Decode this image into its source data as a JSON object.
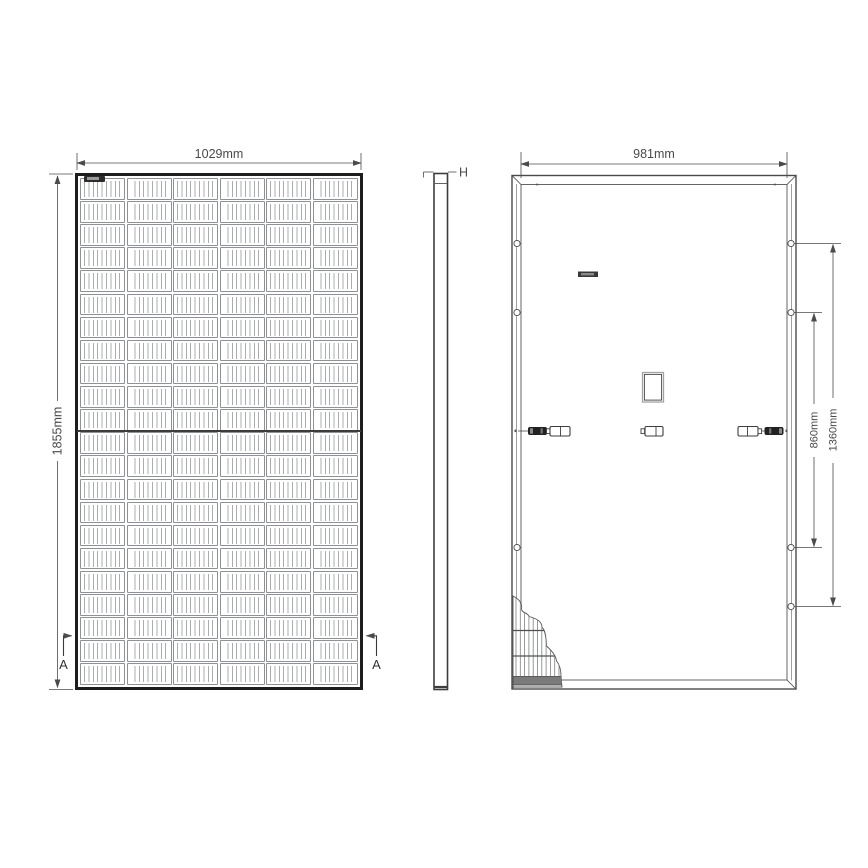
{
  "page": {
    "background": "#ffffff"
  },
  "drawing": {
    "type": "technical-drawing",
    "subject": "solar-panel-module-three-views",
    "front": {
      "dim_width": "1029mm",
      "dim_height": "1855mm",
      "section_marker_left": "A",
      "section_marker_right": "A",
      "cells": {
        "columns": 6,
        "rows": 22,
        "busbars_per_cell": 9
      }
    },
    "side": {
      "dim_thickness": "H"
    },
    "back": {
      "dim_width": "981mm",
      "dim_hole_span_inner": "860mm",
      "dim_hole_span_outer": "1360mm",
      "mounting_holes_left": 3,
      "mounting_holes_right": 4
    },
    "colors": {
      "line": "#4b4b4b",
      "frame": "#1d1d1d",
      "cell_line": "#a8adb0",
      "connector_dark": "#212121"
    }
  }
}
